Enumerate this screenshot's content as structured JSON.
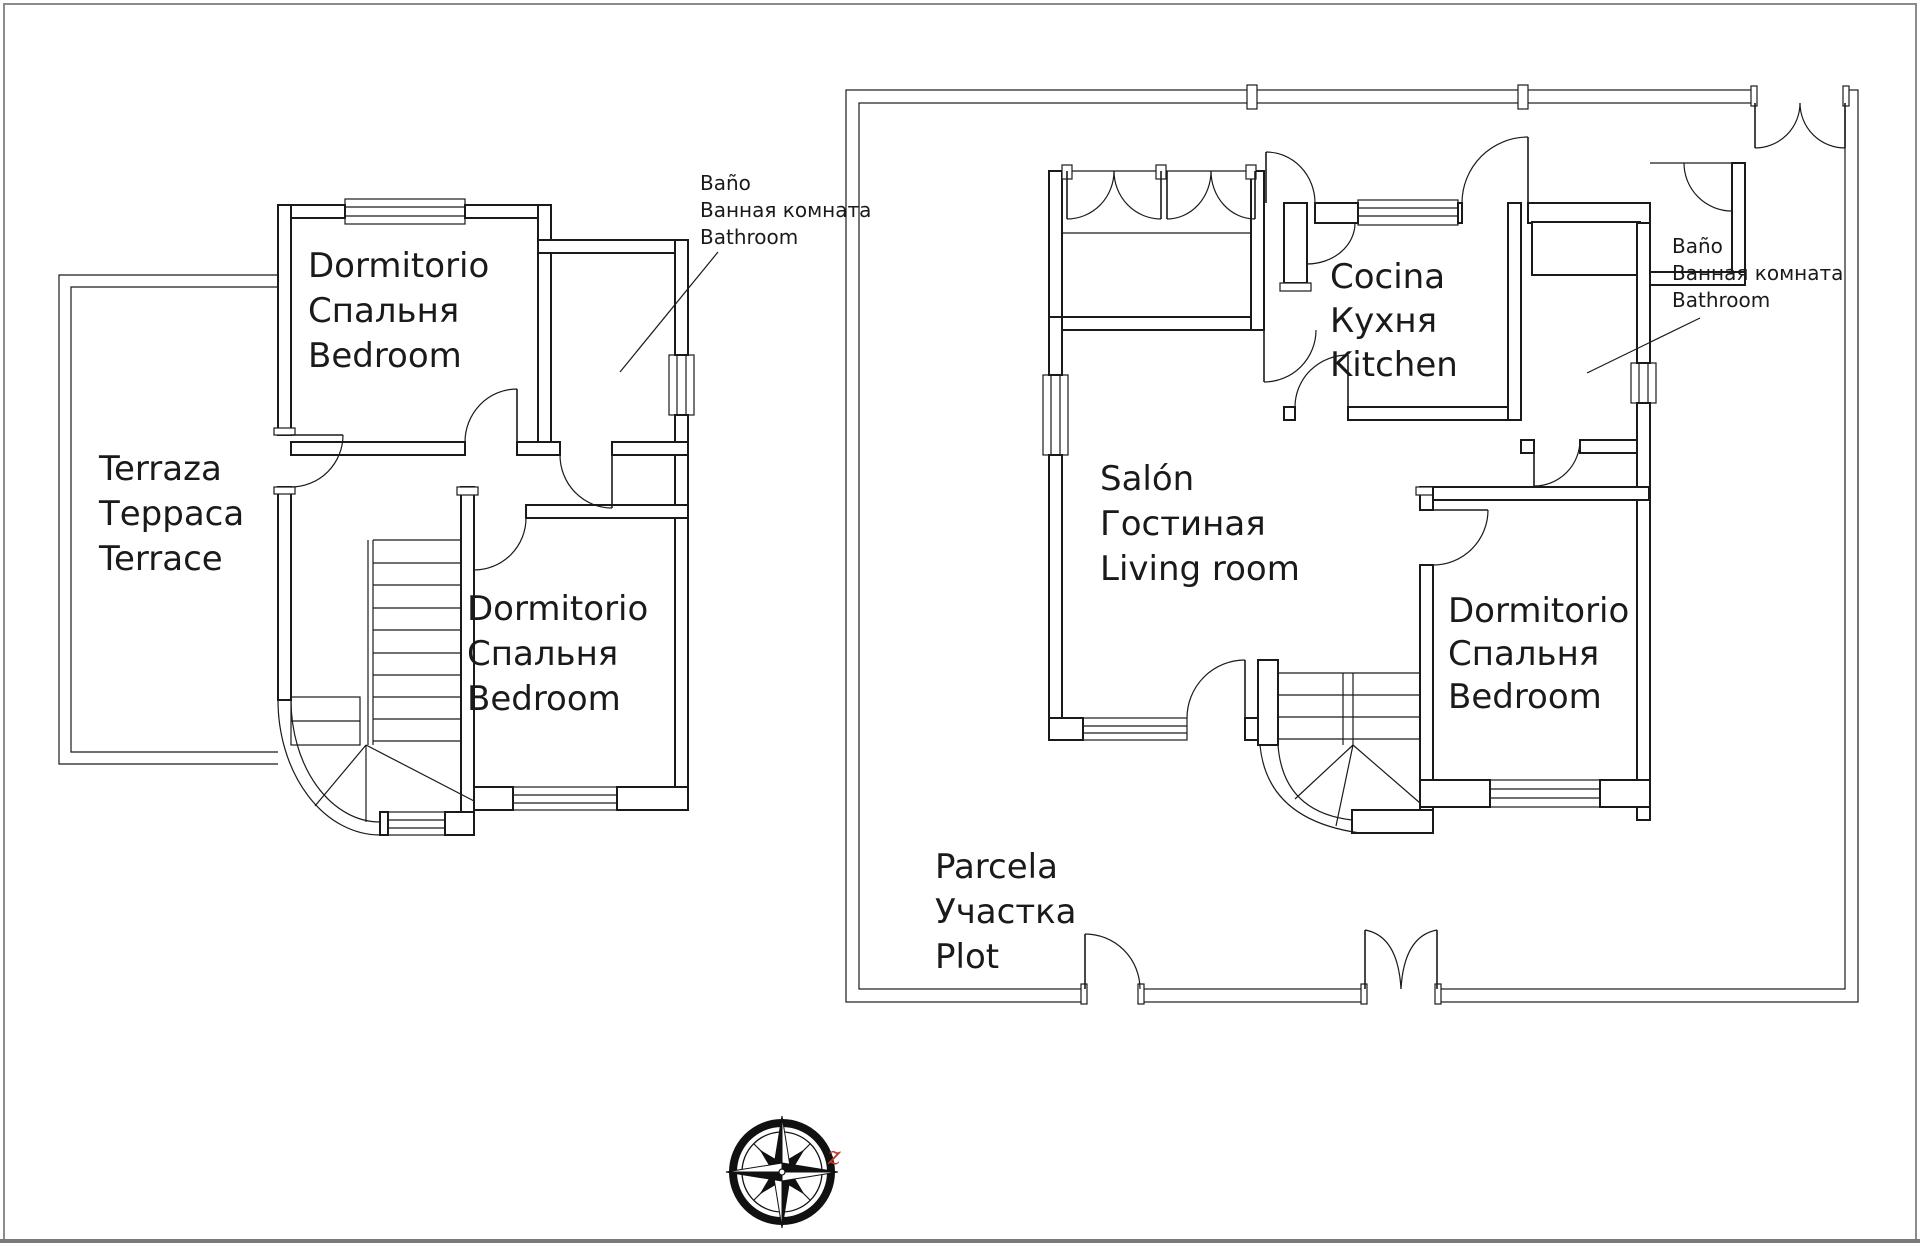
{
  "page": {
    "background": "#ffffff",
    "border_color": "#8c8c8c",
    "line_color": "#1a1a1a"
  },
  "upper_floor_plan": {
    "terrace": {
      "es": "Terraza",
      "ru": "Терраса",
      "en": "Terrace"
    },
    "bedroom_top": {
      "es": "Dormitorio",
      "ru": "Спальня",
      "en": "Bedroom"
    },
    "bedroom_bottom": {
      "es": "Dormitorio",
      "ru": "Спальня",
      "en": "Bedroom"
    },
    "bathroom_note": {
      "es": "Baño",
      "ru": "Ванная комната",
      "en": "Bathroom"
    }
  },
  "ground_floor_plan": {
    "plot": {
      "es": "Parcela",
      "ru": "Участка",
      "en": "Plot"
    },
    "living_room": {
      "es": "Salón",
      "ru": "Гостиная",
      "en": "Living room"
    },
    "kitchen": {
      "es": "Cocina",
      "ru": "Кухня",
      "en": "Kitchen"
    },
    "bedroom": {
      "es": "Dormitorio",
      "ru": "Спальня",
      "en": "Bedroom"
    },
    "bathroom_note": {
      "es": "Baño",
      "ru": "Ванная комната",
      "en": "Bathroom"
    }
  },
  "compass": {
    "east_label": "z",
    "accent_color": "#c0392b"
  }
}
